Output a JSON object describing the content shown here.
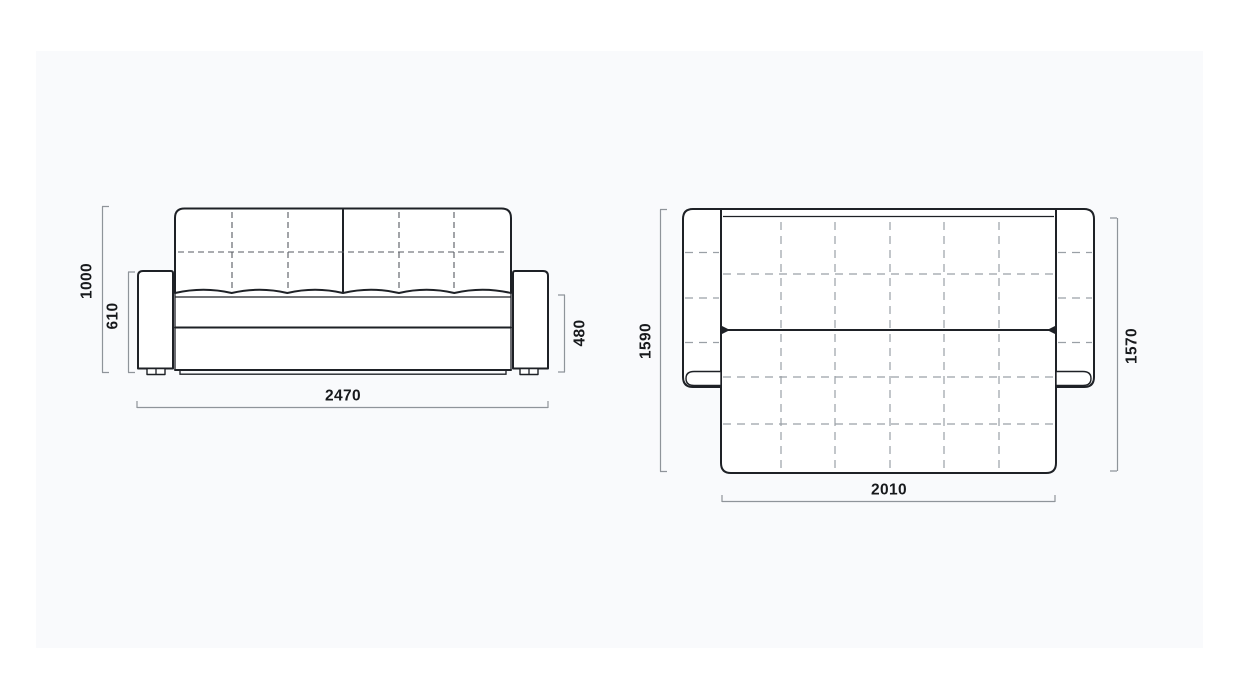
{
  "canvas": {
    "background": "#ffffff",
    "panel_color": "#f9fafc",
    "line_color": "#1e2126",
    "front_dash_color": "#565a60",
    "top_dash_color": "#9aa0a6",
    "dim_line_color": "#8f949a",
    "dim_text_color": "#17191c"
  },
  "front_view": {
    "name": "sofa front elevation",
    "dims": {
      "overall_height": "1000",
      "armrest_height": "610",
      "seat_height": "480",
      "overall_width": "2470"
    }
  },
  "top_view": {
    "name": "sofa-bed unfolded top view",
    "dims": {
      "overall_depth": "1590",
      "bed_depth": "1570",
      "bed_width": "2010"
    }
  }
}
